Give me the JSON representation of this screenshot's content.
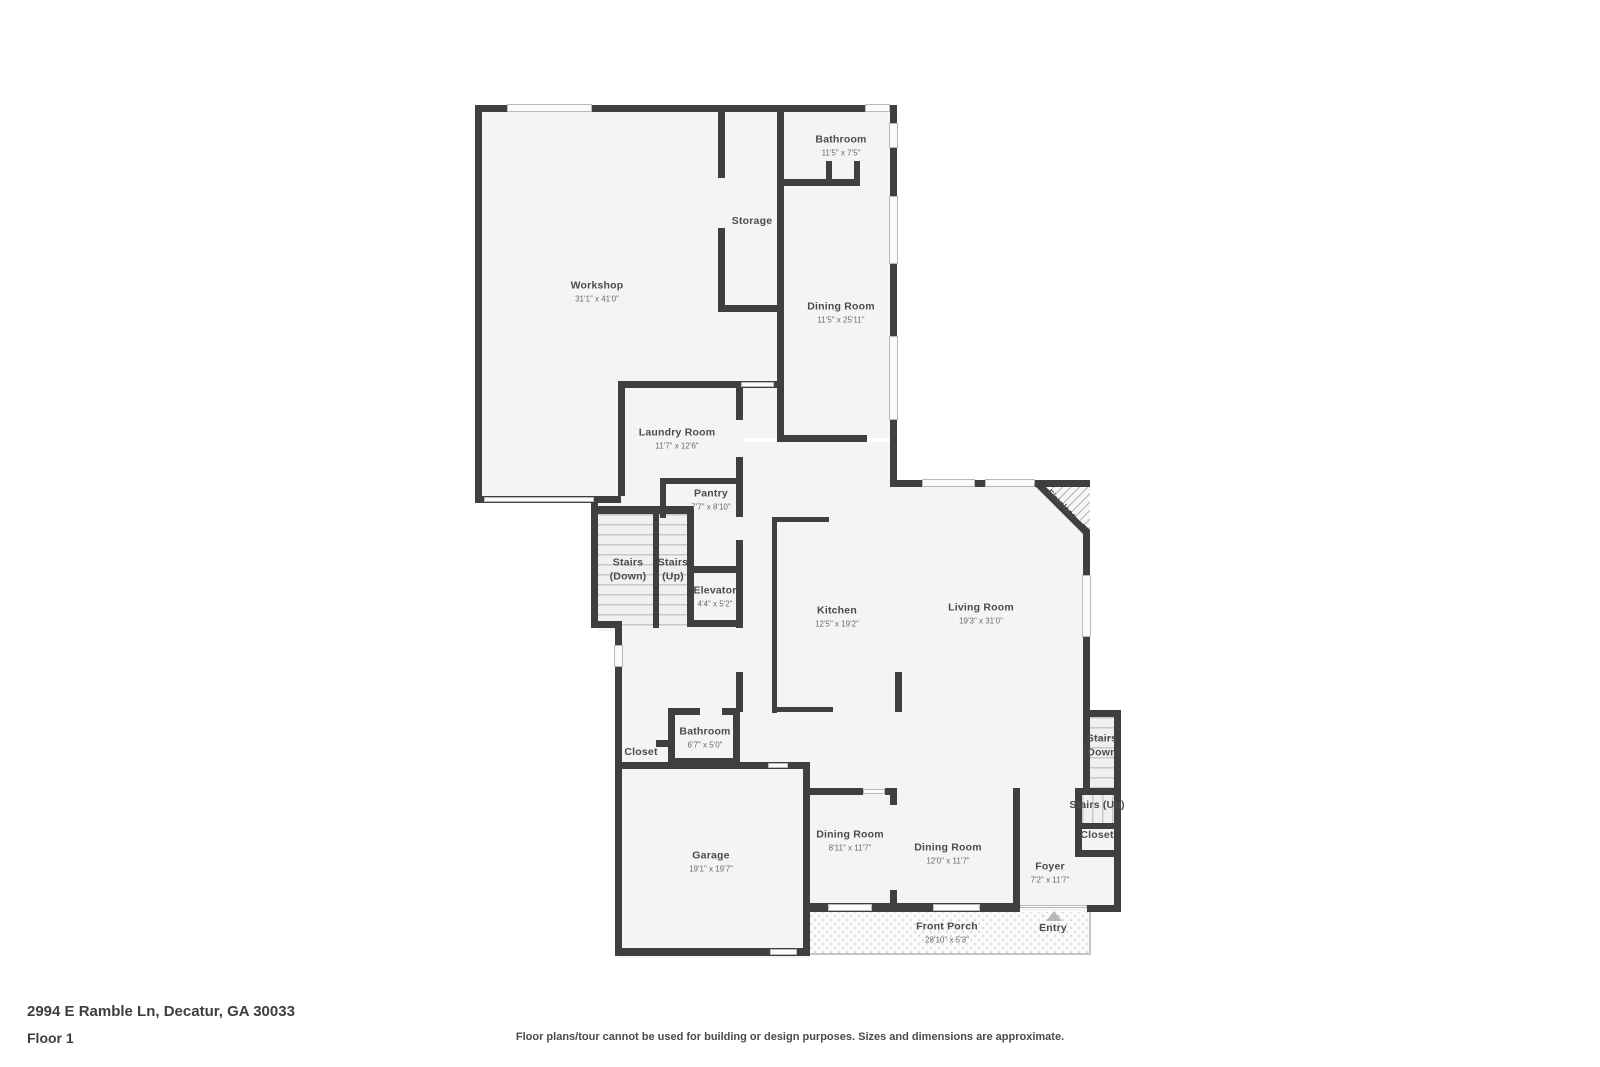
{
  "footer": {
    "address": "2994 E Ramble Ln, Decatur, GA 30033",
    "floor_label": "Floor 1",
    "disclaimer": "Floor plans/tour cannot be used for building or design purposes. Sizes and dimensions are approximate."
  },
  "colors": {
    "wall": "#3f3f3f",
    "room_fill": "#f4f4f4",
    "label_text": "#4b4b4b",
    "dims_text": "#686868"
  },
  "rooms": [
    {
      "name": "Workshop",
      "dims": "31'1\" x 41'0\""
    },
    {
      "name": "Storage"
    },
    {
      "name": "Bathroom",
      "dims": "11'5\" x 7'5\""
    },
    {
      "name": "Dining Room",
      "dims": "11'5\" x 25'11\""
    },
    {
      "name": "Laundry Room",
      "dims": "11'7\" x 12'6\""
    },
    {
      "name": "Pantry",
      "dims": "7'7\" x 8'10\""
    },
    {
      "name": "Stairs (Down)"
    },
    {
      "name": "Stairs (Up)"
    },
    {
      "name": "Elevator",
      "dims": "4'4\" x 5'2\""
    },
    {
      "name": "Kitchen",
      "dims": "12'5\" x 19'2\""
    },
    {
      "name": "Living Room",
      "dims": "19'3\" x 31'0\""
    },
    {
      "name": "Fireplace"
    },
    {
      "name": "Bathroom",
      "dims": "6'7\" x 5'0\""
    },
    {
      "name": "Closet"
    },
    {
      "name": "Garage",
      "dims": "19'1\" x 19'7\""
    },
    {
      "name": "Dining Room",
      "dims": "8'11\" x 11'7\""
    },
    {
      "name": "Dining Room",
      "dims": "12'0\" x 11'7\""
    },
    {
      "name": "Foyer",
      "dims": "7'2\" x 11'7\""
    },
    {
      "name": "Front Porch",
      "dims": "28'10\" x 5'3\""
    },
    {
      "name": "Entry"
    },
    {
      "name": "Stairs (Down)"
    },
    {
      "name": "Stairs (Up)"
    },
    {
      "name": "Closet"
    }
  ]
}
